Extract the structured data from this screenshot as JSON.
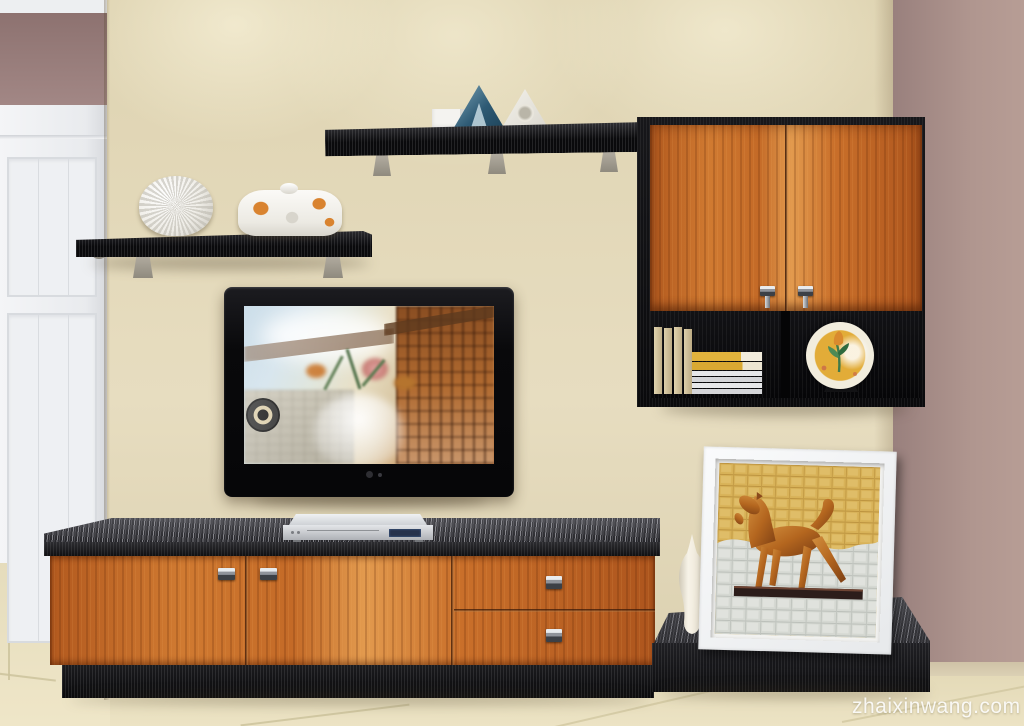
{
  "watermark": {
    "text": "zhaixinwang.com"
  },
  "scene": {
    "type": "interior-3d-render",
    "room": "living room TV feature wall with modern wall unit",
    "objects": [
      "white paneled door",
      "beige feature wall",
      "mauve side walls",
      "black floating shelf with white spiky ornament and floral covered dish",
      "long black floating shelf with blue and white triangle ornaments",
      "orange two-door wall cabinet with open black shelf",
      "books and yellow magazine stack",
      "decorative yellow plate on stand",
      "wall mounted flat screen TV",
      "silver DVD player",
      "orange TV lowboard with two doors and two drawers on black plinth",
      "black display platform",
      "tall white vase",
      "white framed painting of a bronze horse sculpture",
      "beige tiled floor"
    ]
  },
  "palette": {
    "wall_beige": "#e3d9ba",
    "wall_mauve": "#a58a86",
    "wood_orange": "#c9702c",
    "wood_black": "#141416",
    "floor_beige": "#e9e0c1",
    "door_white": "#eff1f3",
    "dvd_silver": "#c9cbcf",
    "plate_yellow": "#e2ac38",
    "frame_white": "#f2f3f4",
    "watermark_color": "rgba(255,255,255,0.88)"
  }
}
